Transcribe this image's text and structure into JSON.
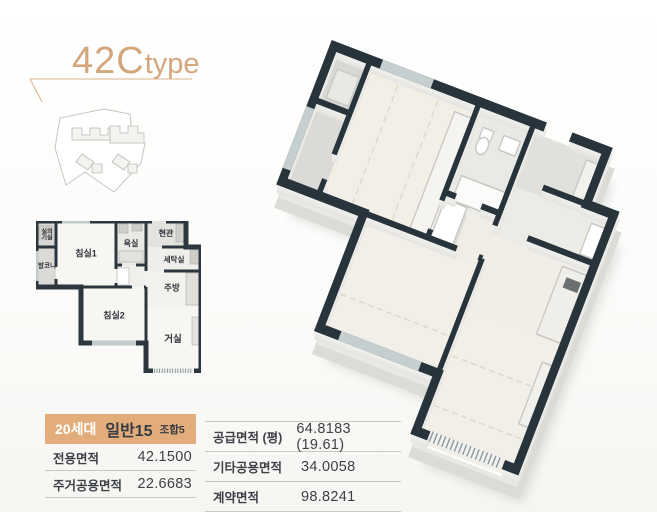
{
  "header": {
    "title_main": "42C",
    "title_sub": "type"
  },
  "floorplan": {
    "rooms": [
      {
        "id": "outdoor-unit-room",
        "label": "실외\n기실"
      },
      {
        "id": "balcony",
        "label": "발코니"
      },
      {
        "id": "bedroom1",
        "label": "침실1"
      },
      {
        "id": "bathroom",
        "label": "욕실"
      },
      {
        "id": "entrance",
        "label": "현관"
      },
      {
        "id": "laundry",
        "label": "세탁실"
      },
      {
        "id": "kitchen",
        "label": "주방"
      },
      {
        "id": "bedroom2",
        "label": "침실2"
      },
      {
        "id": "living-room",
        "label": "거실"
      }
    ]
  },
  "stats_left": {
    "header": {
      "units": "20세대",
      "general": "일반15",
      "association": "조합5"
    },
    "rows": [
      {
        "label": "전용면적",
        "value": "42.1500"
      },
      {
        "label": "주거공용면적",
        "value": "22.6683"
      }
    ]
  },
  "stats_right": {
    "rows": [
      {
        "label": "공급면적 (평)",
        "value": "64.8183 (19.61)"
      },
      {
        "label": "기타공용면적",
        "value": "34.0058"
      },
      {
        "label": "계약면적",
        "value": "98.8241"
      }
    ]
  },
  "colors": {
    "accent_tan": "#d4a67c",
    "table_header_bg": "#e2ad7a",
    "wall_dark": "#27343c",
    "floor_cream": "#f2efe7"
  }
}
